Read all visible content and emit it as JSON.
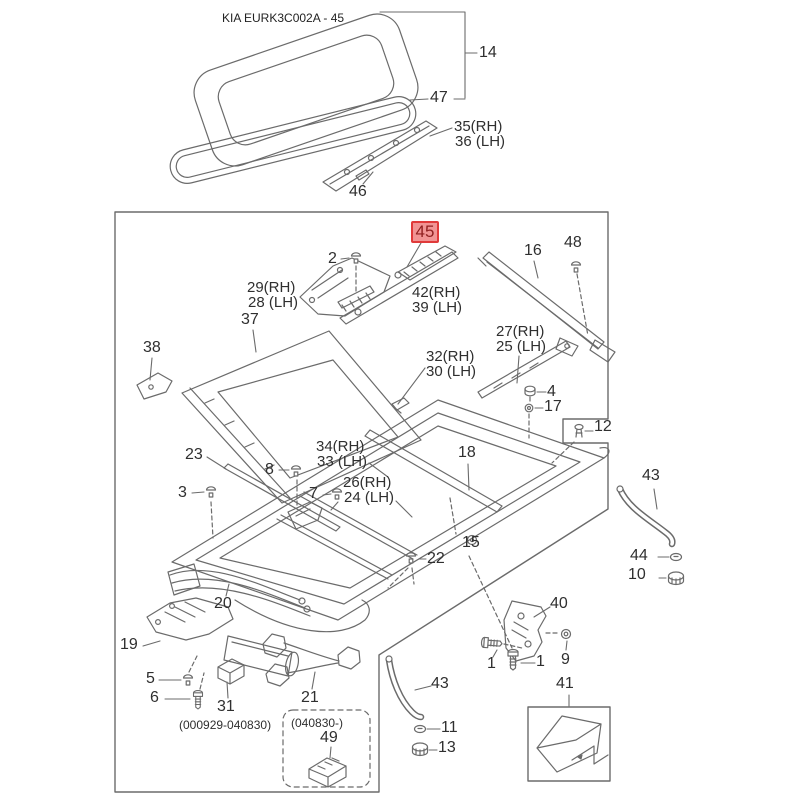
{
  "title": "KIA EURK3C002A - 45",
  "highlight": {
    "label": "45",
    "bg": "#f19494",
    "border": "#e03a3a",
    "text_color": "#8f1f1f"
  },
  "colors": {
    "background": "#ffffff",
    "line_art": "#6b6b6b",
    "label_text": "#2f2f2f",
    "box_border": "#6b6b6b"
  },
  "callouts": {
    "c14": "14",
    "c47": "47",
    "c35": "35(RH)",
    "c36": "36 (LH)",
    "c46": "46",
    "c2": "2",
    "c29": "29(RH)",
    "c28": "28 (LH)",
    "c16": "16",
    "c48": "48",
    "c42": "42(RH)",
    "c39": "39 (LH)",
    "c27": "27(RH)",
    "c25": "25 (LH)",
    "c37": "37",
    "c38": "38",
    "c32": "32(RH)",
    "c30": "30 (LH)",
    "c4": "4",
    "c17": "17",
    "c12": "12",
    "c34": "34(RH)",
    "c33": "33 (LH)",
    "c23": "23",
    "c18": "18",
    "c26": "26(RH)",
    "c24": "24 (LH)",
    "c8": "8",
    "c3": "3",
    "c7": "7",
    "c22": "22",
    "c15": "15",
    "c20": "20",
    "c19": "19",
    "c5": "5",
    "c6": "6",
    "c31": "31",
    "range_early": "(000929-040830)",
    "range_late": "(040830-)",
    "c49": "49",
    "c21": "21",
    "c40": "40",
    "c1a": "1",
    "c1b": "1",
    "c9": "9",
    "c41": "41",
    "c43_bottom": "43",
    "c11": "11",
    "c13": "13",
    "c43_right": "43",
    "c44": "44",
    "c10": "10"
  }
}
